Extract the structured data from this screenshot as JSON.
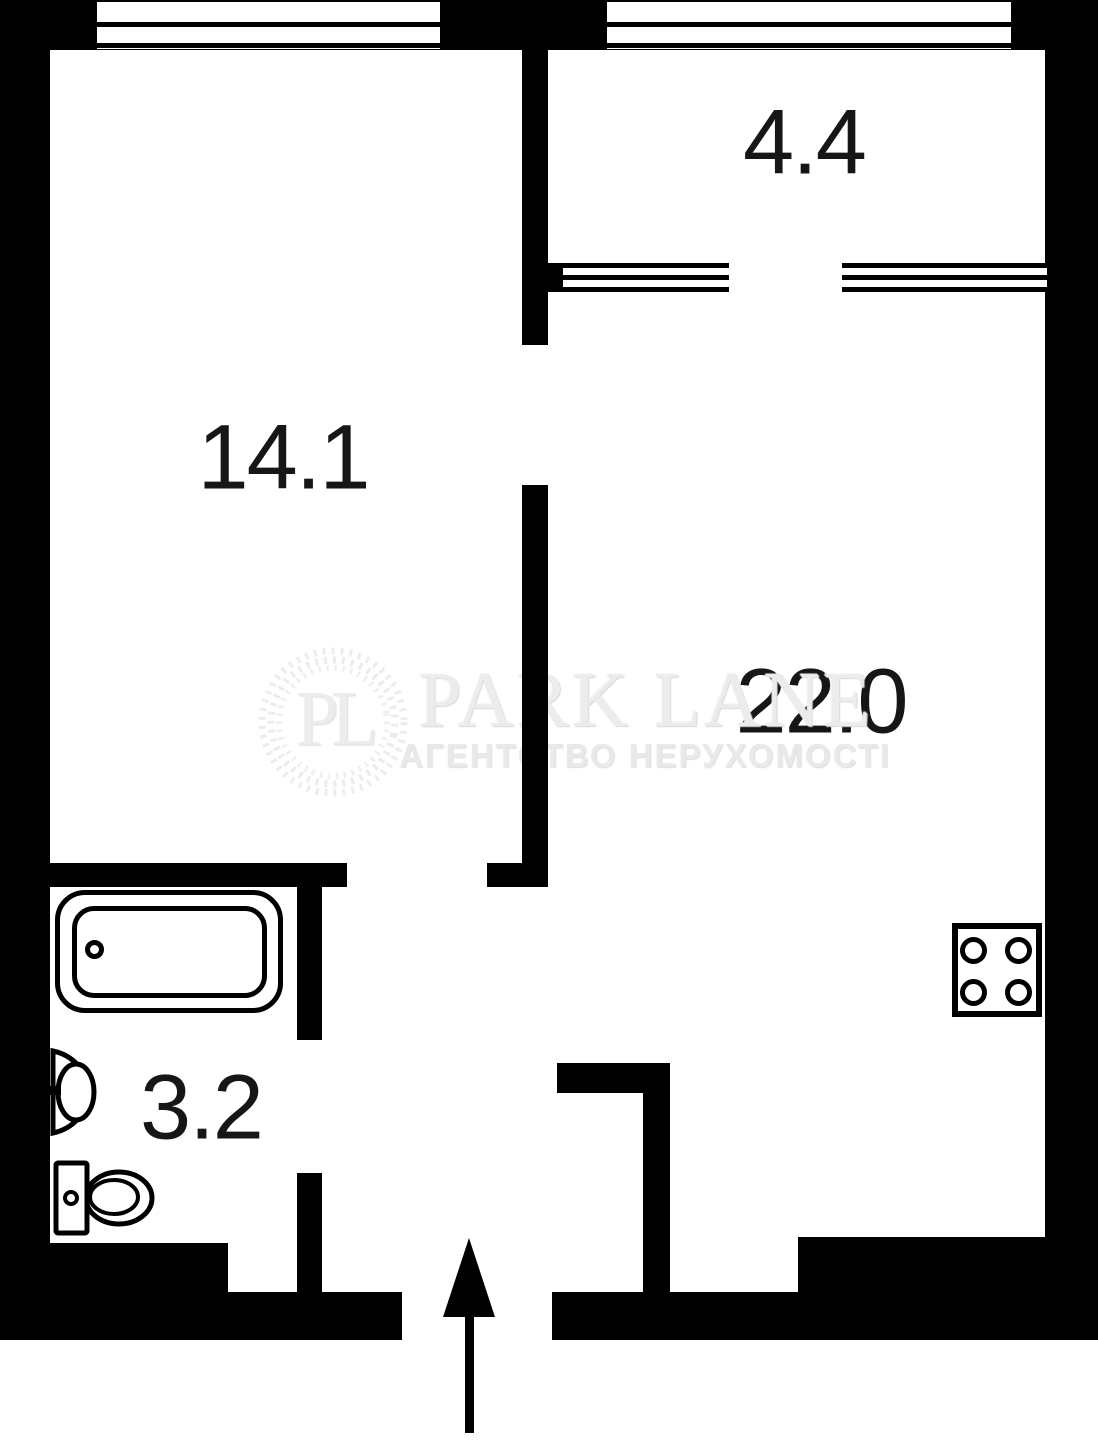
{
  "floorplan": {
    "type": "apartment-floor-plan",
    "rooms": [
      {
        "name": "room",
        "area_label": "14.1"
      },
      {
        "name": "balcony",
        "area_label": "4.4"
      },
      {
        "name": "living-kitchen",
        "area_label": "22.0"
      },
      {
        "name": "bathroom",
        "area_label": "3.2"
      }
    ],
    "fixtures": [
      "bathtub",
      "sink",
      "toilet",
      "stove",
      "entrance-arrow"
    ],
    "watermark": {
      "monogram": "PL",
      "brand": "PARK LANE",
      "tagline": "АГЕНТСТВО НЕРУХОМОСТІ"
    },
    "colors": {
      "wall": "#000000",
      "background": "#ffffff",
      "label_text": "#161616",
      "watermark_gray": "#ececec"
    }
  }
}
